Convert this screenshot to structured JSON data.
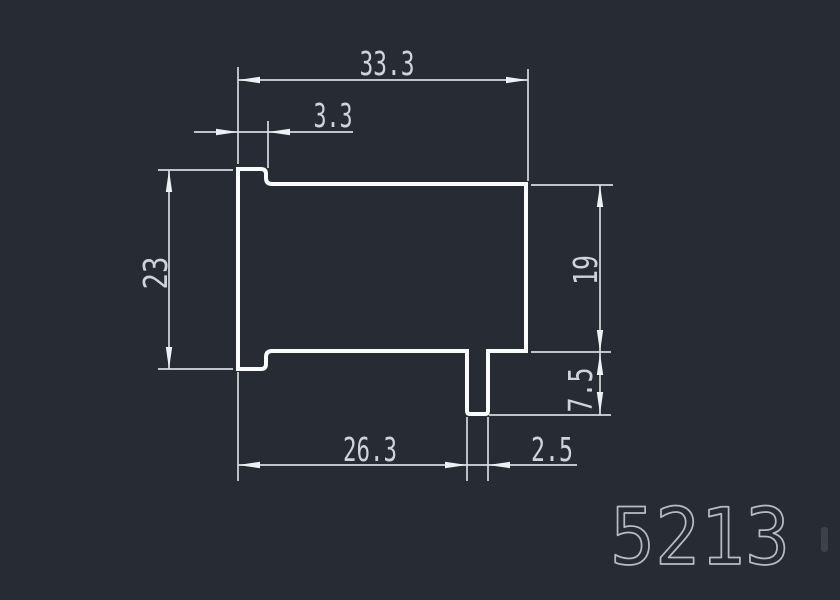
{
  "canvas": {
    "background_color": "#262b34",
    "outline_color": "#fafbfd",
    "dimension_color": "#d7dbdf",
    "text_color": "#cfd4d9",
    "part_number_color": "#b6bcc3"
  },
  "drawing": {
    "part_number": "5213",
    "dims": {
      "overall_width": "33.3",
      "flange_thickness": "3.3",
      "overall_height": "23",
      "body_height": "19",
      "leg_height": "7.5",
      "bottom_width": "26.3",
      "leg_width": "2.5"
    }
  }
}
